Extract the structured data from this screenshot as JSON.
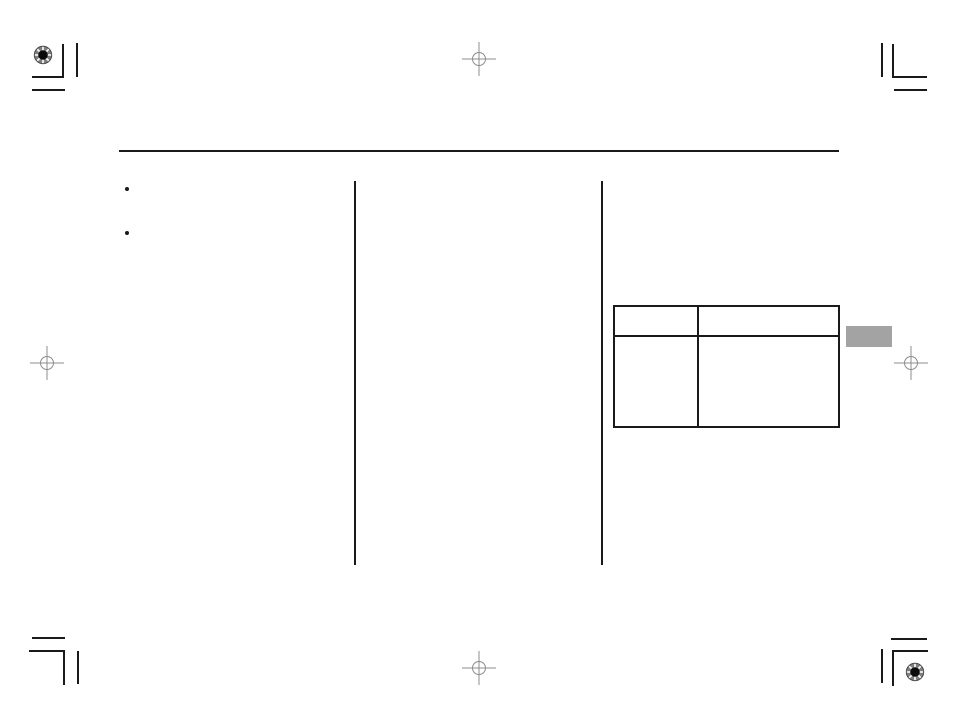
{
  "page": {
    "background": "#ffffff"
  },
  "colors": {
    "line": "#1a1a1a",
    "reg": "#8c8c8c",
    "tab": "#a3a3a3"
  },
  "content": {
    "header_rule_label": "",
    "bullets": [
      "",
      ""
    ],
    "table": {
      "header": [
        "",
        ""
      ],
      "rows": [
        [
          "",
          ""
        ]
      ]
    },
    "side_tab_label": ""
  },
  "print_marks": {
    "registration_target_corners": [
      "top-left",
      "bottom-right"
    ],
    "crosshair_positions": [
      "top-center",
      "left-center",
      "right-center",
      "bottom-center"
    ],
    "crop_mark_corners": [
      "top-left",
      "top-right",
      "bottom-left",
      "bottom-right"
    ]
  }
}
